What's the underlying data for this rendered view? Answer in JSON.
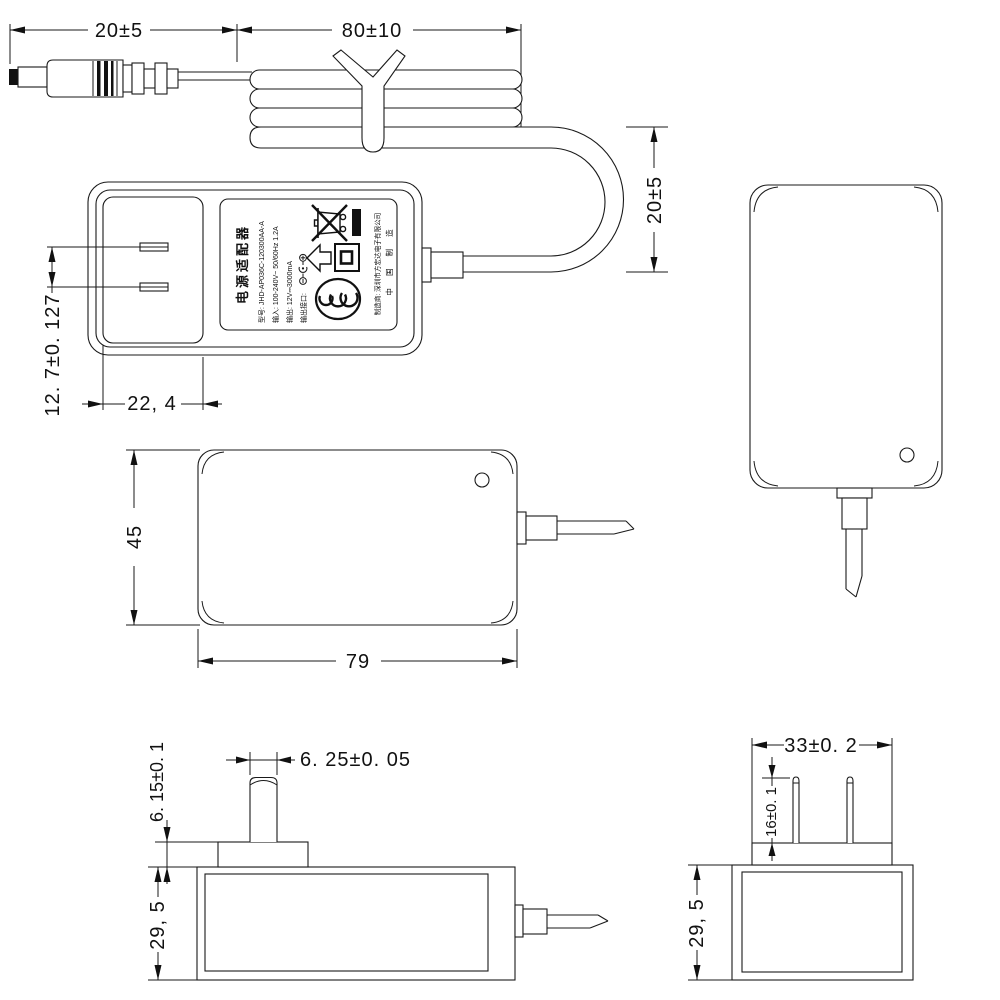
{
  "drawing": {
    "background": "#ffffff",
    "line_color": "#1a1a1a",
    "views": {
      "cable": {
        "dim_connector_length": "20±5",
        "dim_coil_length": "80±10",
        "dim_loop_height": "20±5"
      },
      "front": {
        "dim_prong_pitch": "12. 7±0. 127",
        "dim_recess_width": "22, 4"
      },
      "back": {
        "dim_body_height": "45",
        "dim_body_width": "79"
      },
      "top": {
        "dim_prong_width": "6. 25±0. 05",
        "dim_base_height": "6. 15±0. 1",
        "dim_body_depth": "29, 5"
      },
      "end": {
        "dim_base_width": "33±0. 2",
        "dim_prong_length": "16±0. 1",
        "dim_body_depth": "29, 5"
      }
    },
    "label": {
      "title": "电源适配器",
      "model": "型号: JHD-AP036C-120300AA-A",
      "input": "输入: 100-240V~ 50/60Hz 1.2A",
      "output": "输出: 12V⎓3000mA",
      "port": "输出接口:",
      "manufacturer": "制造商: 深圳市方宏达电子有限公司",
      "made_in": "中 国 制 造",
      "icons": [
        "polarity-icon",
        "up-arrow-icon",
        "class-ii-icon",
        "weee-bin-icon",
        "ccc-mark-icon"
      ]
    }
  }
}
